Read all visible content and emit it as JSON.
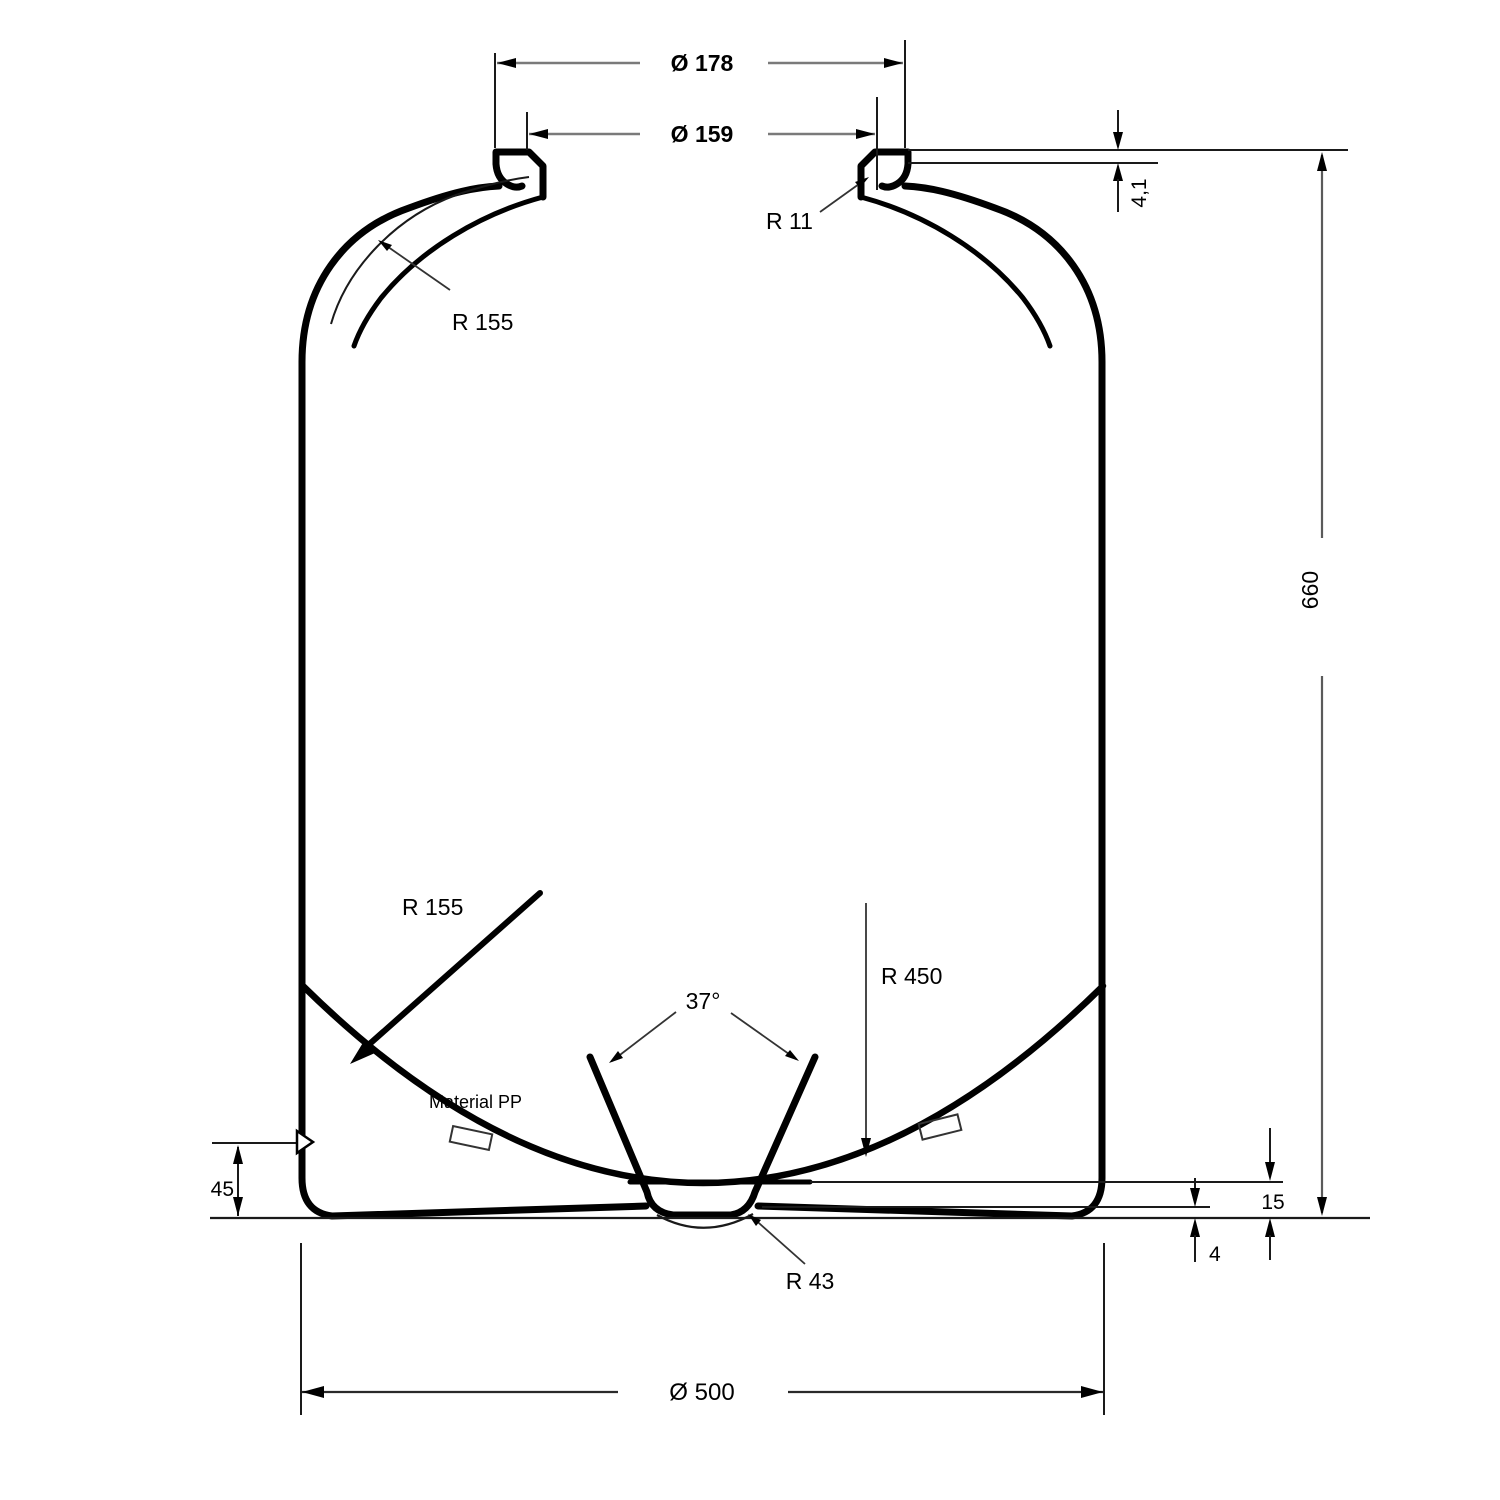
{
  "drawing": {
    "type": "technical-section-drawing",
    "subject": "plastic-drum-cross-section",
    "labels": {
      "neck_outer_dia": "Ø 178",
      "neck_inner_dia": "Ø 159",
      "neck_radius": "R 11",
      "lip_height": "4,1",
      "shoulder_radius": "R 155",
      "overall_height": "660",
      "bottom_shoulder_radius": "R 155",
      "dish_radius": "R 450",
      "cone_angle": "37°",
      "material_note": "Material PP",
      "foot_height": "45",
      "cup_depth": "15",
      "base_clearance": "4",
      "cup_radius": "R 43",
      "body_dia": "Ø 500"
    },
    "colors": {
      "background": "#ffffff",
      "outline": "#000000",
      "dimension_line": "#7a7a7a",
      "reference_line": "#1a1a1a",
      "leader_line": "#333333"
    }
  }
}
